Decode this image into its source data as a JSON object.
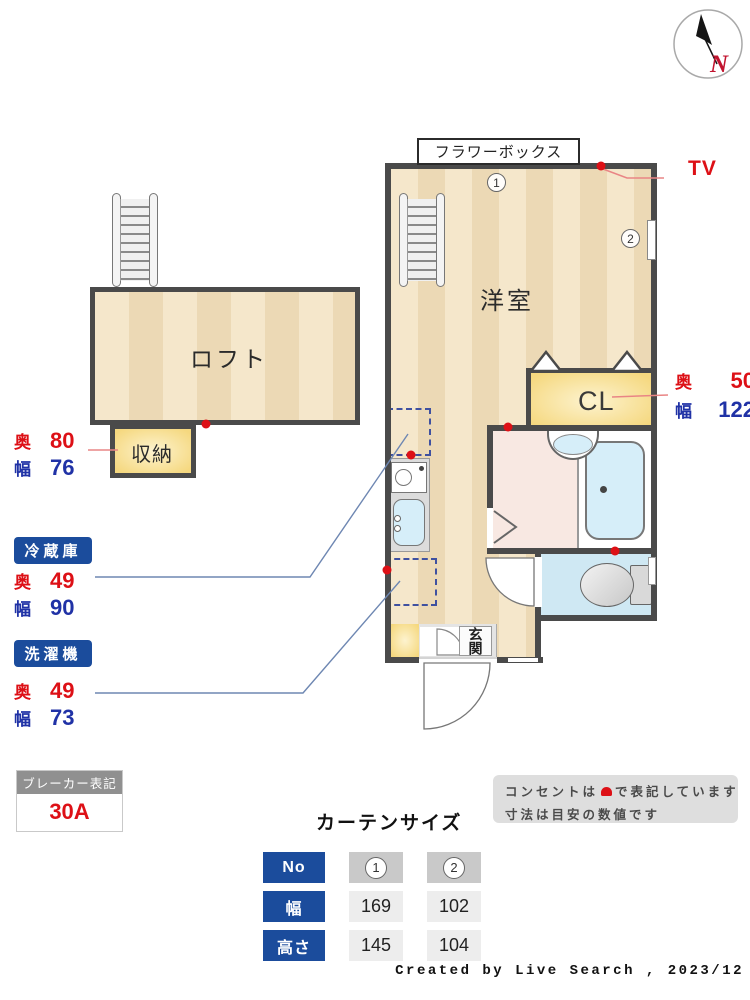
{
  "colors": {
    "accent_blue": "#1b4c9c",
    "dim_red": "#dd1016",
    "dim_blue": "#2032a6",
    "wall": "#4a4a4a",
    "outlet_red": "#dd1016",
    "leader_blue": "#6e87b2",
    "leader_red": "#e98585",
    "floor_light": "#f5e7cb",
    "floor_dark": "#ecd9b5",
    "yellow_light": "#fdf3cf",
    "yellow_dark": "#f5d87f",
    "bath_pink": "#f8e8e2",
    "water_blue": "#d6eef9",
    "toilet_blue": "#cfe8f3",
    "gray_box": "#dedede",
    "header_gray": "#909090"
  },
  "compass": {
    "north_label": "N"
  },
  "plan": {
    "rooms": {
      "living": "洋室",
      "loft": "ロフト",
      "storage": "収納",
      "closet": "CL",
      "entrance": "玄関"
    },
    "flower_box": "フラワーボックス",
    "tv_label": "TV",
    "curtain_tags": {
      "tag1": "1",
      "tag2": "2"
    },
    "dims": {
      "storage": {
        "depth_label": "奥",
        "depth_value": "80",
        "width_label": "幅",
        "width_value": "76"
      },
      "closet": {
        "depth_label": "奥",
        "depth_value": "50",
        "width_label": "幅",
        "width_value": "122"
      },
      "fridge": {
        "name": "冷蔵庫",
        "depth_label": "奥",
        "depth_value": "49",
        "width_label": "幅",
        "width_value": "90"
      },
      "washer": {
        "name": "洗濯機",
        "depth_label": "奥",
        "depth_value": "49",
        "width_label": "幅",
        "width_value": "73"
      }
    }
  },
  "breaker": {
    "title": "ブレーカー表記",
    "value": "30A"
  },
  "notice": {
    "line1_before": "コンセントは",
    "line1_after": "で表記しています",
    "line2": "寸法は目安の数値です"
  },
  "curtain_table": {
    "title": "カーテンサイズ",
    "row_headers": [
      "No",
      "幅",
      "高さ"
    ],
    "columns": [
      {
        "no": "1",
        "width": "169",
        "height": "145"
      },
      {
        "no": "2",
        "width": "102",
        "height": "104"
      }
    ]
  },
  "credit": "Created by Live Search , 2023/12"
}
